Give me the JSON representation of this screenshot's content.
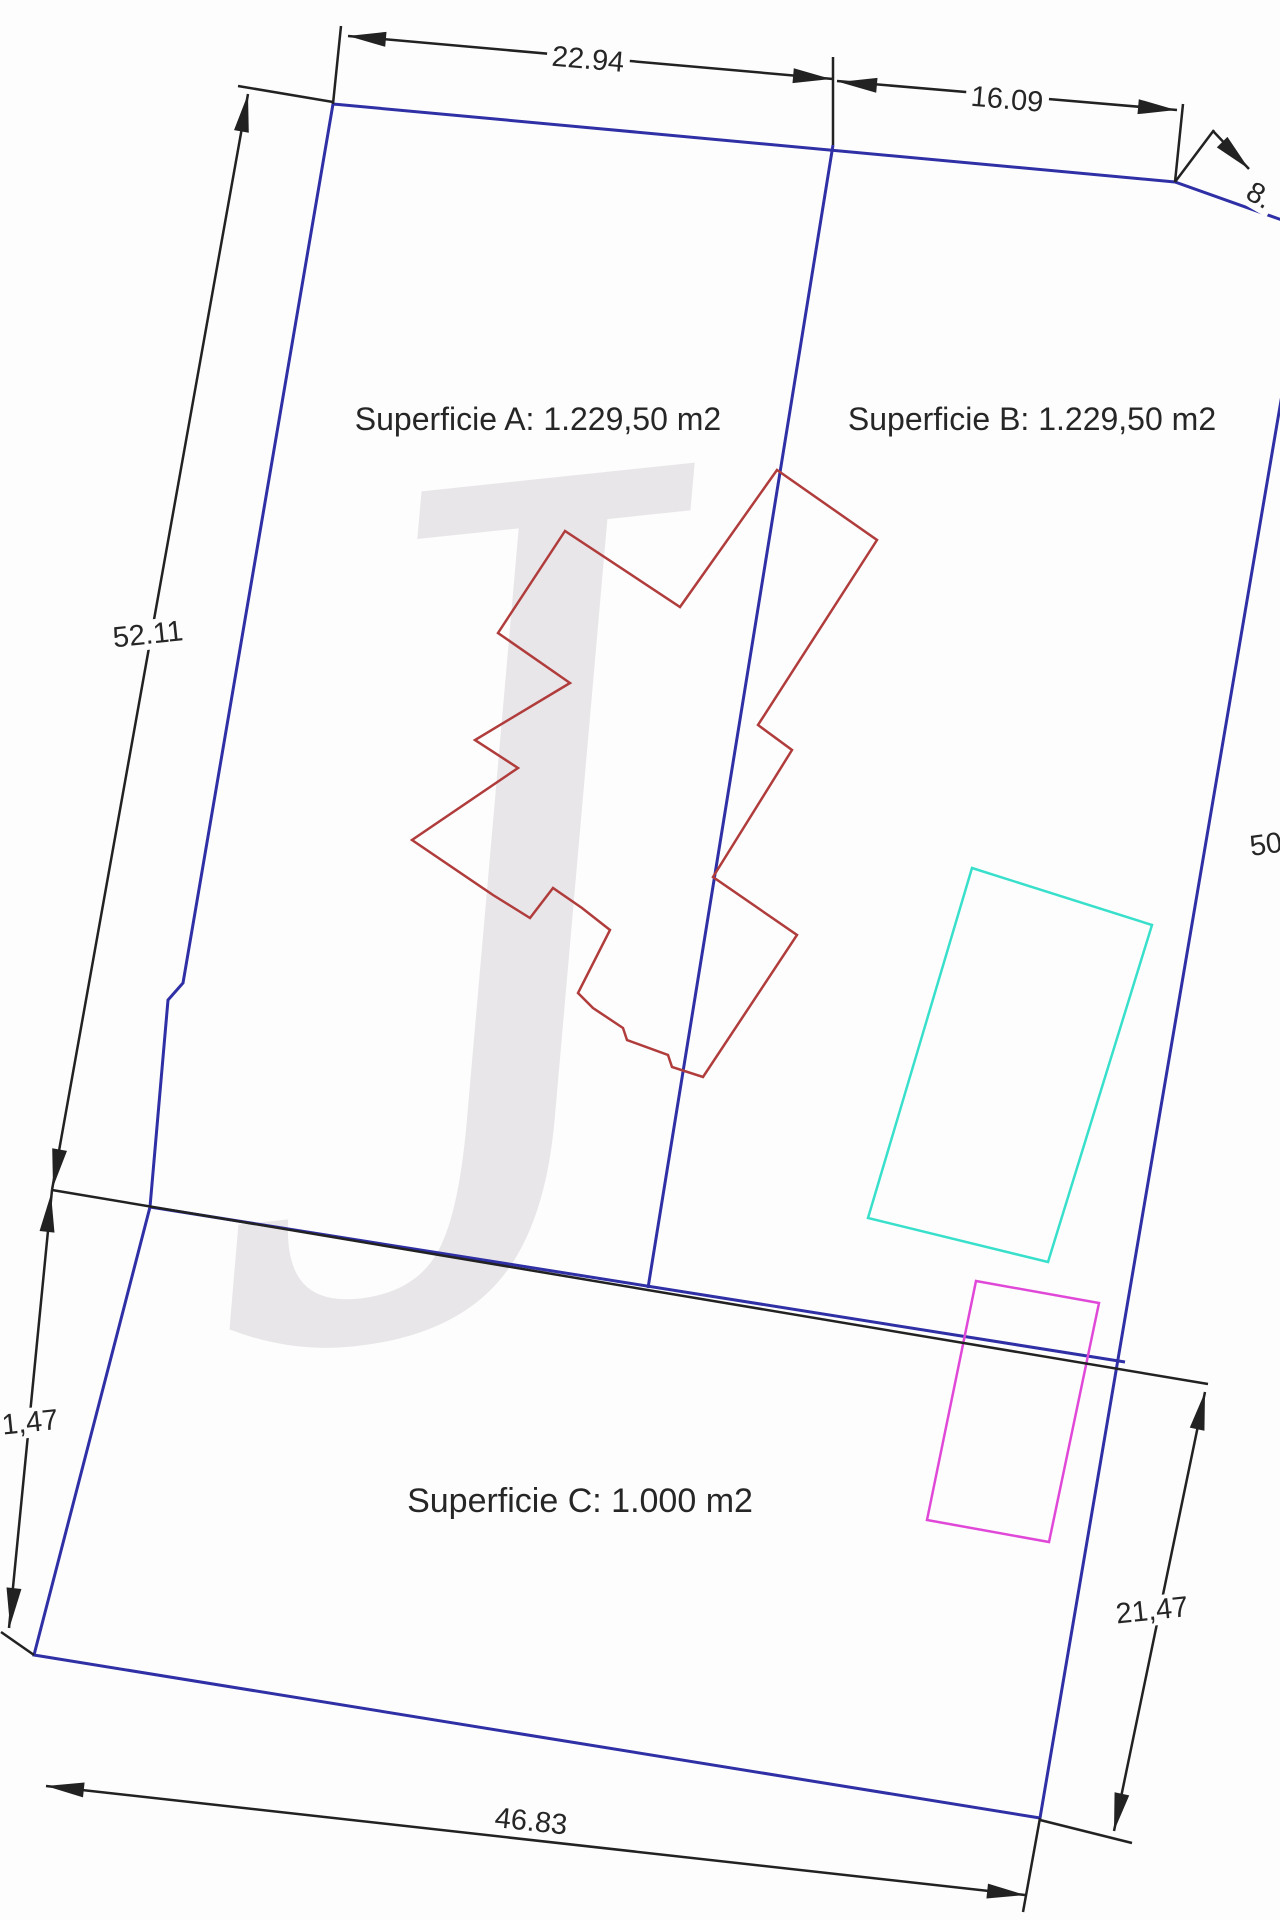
{
  "colors": {
    "blue": "#2f2fa6",
    "red": "#b03c3c",
    "cyan": "#38e0cb",
    "magenta": "#e048d8",
    "black": "#222222",
    "text": "#262626",
    "watermark": "#c9c2c9"
  },
  "areas": {
    "a": {
      "label": "Superficie A: 1.229,50 m2"
    },
    "b": {
      "label": "Superficie B: 1.229,50 m2"
    },
    "c": {
      "label": "Superficie C: 1.000 m2"
    }
  },
  "watermark": {
    "glyph": "J"
  },
  "labels": {
    "area-a": {
      "text": "Superficie A: 1.229,50 m2",
      "x": 538,
      "y": 420,
      "rot": 0,
      "size": 32,
      "dim": false
    },
    "area-b": {
      "text": "Superficie B: 1.229,50 m2",
      "x": 1032,
      "y": 420,
      "rot": 0,
      "size": 32,
      "dim": false
    },
    "area-c": {
      "text": "Superficie C: 1.000 m2",
      "x": 580,
      "y": 1502,
      "rot": 0,
      "size": 34,
      "dim": false
    },
    "dim-top-left": {
      "text": "22.94",
      "x": 588,
      "y": 60,
      "rot": 5,
      "size": 29,
      "dim": true
    },
    "dim-top-right": {
      "text": "16.09",
      "x": 1007,
      "y": 100,
      "rot": 5,
      "size": 29,
      "dim": true
    },
    "dim-diagonal": {
      "text": "8.",
      "x": 1259,
      "y": 196,
      "rot": 30,
      "size": 29,
      "dim": true
    },
    "dim-left": {
      "text": "52.11",
      "x": 148,
      "y": 635,
      "rot": -6,
      "size": 29,
      "dim": true
    },
    "dim-right": {
      "text": "50",
      "x": 1266,
      "y": 845,
      "rot": -8,
      "size": 29,
      "dim": true
    },
    "dim-bottom-left": {
      "text": "1,47",
      "x": 30,
      "y": 1423,
      "rot": -6,
      "size": 29,
      "dim": true
    },
    "dim-bottom-right": {
      "text": "21,47",
      "x": 1152,
      "y": 1611,
      "rot": -6,
      "size": 29,
      "dim": true
    },
    "dim-bottom": {
      "text": "46.83",
      "x": 531,
      "y": 1822,
      "rot": 6,
      "size": 29,
      "dim": true
    }
  },
  "geometry": {
    "shapes": [
      {
        "name": "parcel-boundary",
        "type": "polygon",
        "color": "blue",
        "width": 3,
        "points": [
          [
            333,
            104
          ],
          [
            1175,
            182
          ],
          [
            1310,
            230
          ],
          [
            1040,
            1818
          ],
          [
            34,
            1655
          ],
          [
            150,
            1207
          ],
          [
            168,
            1000
          ],
          [
            183,
            983
          ]
        ]
      },
      {
        "name": "divider-a-b",
        "type": "polyline",
        "color": "blue",
        "width": 3,
        "points": [
          [
            833,
            145
          ],
          [
            648,
            1288
          ]
        ]
      },
      {
        "name": "divider-c",
        "type": "polyline",
        "color": "blue",
        "width": 3,
        "points": [
          [
            150,
            1207
          ],
          [
            1125,
            1362
          ]
        ]
      },
      {
        "name": "building-outline",
        "type": "polygon",
        "color": "red",
        "width": 2.5,
        "points": [
          [
            565,
            531
          ],
          [
            498,
            633
          ],
          [
            570,
            683
          ],
          [
            475,
            740
          ],
          [
            518,
            768
          ],
          [
            412,
            840
          ],
          [
            493,
            895
          ],
          [
            530,
            918
          ],
          [
            553,
            888
          ],
          [
            582,
            908
          ],
          [
            610,
            930
          ],
          [
            578,
            993
          ],
          [
            593,
            1008
          ],
          [
            623,
            1028
          ],
          [
            627,
            1040
          ],
          [
            668,
            1055
          ],
          [
            672,
            1067
          ],
          [
            703,
            1077
          ],
          [
            797,
            935
          ],
          [
            713,
            877
          ],
          [
            792,
            750
          ],
          [
            758,
            725
          ],
          [
            877,
            540
          ],
          [
            777,
            470
          ],
          [
            680,
            607
          ]
        ]
      },
      {
        "name": "cyan-structure",
        "type": "polygon",
        "color": "cyan",
        "width": 2.5,
        "points": [
          [
            972,
            868
          ],
          [
            1152,
            925
          ],
          [
            1048,
            1262
          ],
          [
            868,
            1218
          ]
        ]
      },
      {
        "name": "magenta-structure",
        "type": "polygon",
        "color": "magenta",
        "width": 2.5,
        "points": [
          [
            976,
            1281
          ],
          [
            1099,
            1303
          ],
          [
            1049,
            1542
          ],
          [
            927,
            1520
          ]
        ]
      },
      {
        "name": "dim-line-22-94",
        "type": "polyline",
        "color": "black",
        "width": 2.5,
        "points": [
          [
            348,
            36
          ],
          [
            833,
            79
          ]
        ]
      },
      {
        "name": "dim-line-16-09",
        "type": "polyline",
        "color": "black",
        "width": 2.5,
        "points": [
          [
            837,
            81
          ],
          [
            1177,
            110
          ]
        ]
      },
      {
        "name": "dim-line-8",
        "type": "polyline",
        "color": "black",
        "width": 2.5,
        "points": [
          [
            1213,
            131
          ],
          [
            1249,
            169
          ]
        ]
      },
      {
        "name": "ext-line-top-left-v",
        "type": "polyline",
        "color": "black",
        "width": 2.5,
        "points": [
          [
            341,
            26
          ],
          [
            333,
            104
          ]
        ]
      },
      {
        "name": "ext-line-top-mid",
        "type": "polyline",
        "color": "black",
        "width": 2.5,
        "points": [
          [
            833,
            57
          ],
          [
            833,
            145
          ]
        ]
      },
      {
        "name": "ext-line-top-right",
        "type": "polyline",
        "color": "black",
        "width": 2.5,
        "points": [
          [
            1183,
            104
          ],
          [
            1175,
            182
          ]
        ]
      },
      {
        "name": "ext-line-top-left-h",
        "type": "polyline",
        "color": "black",
        "width": 2.5,
        "points": [
          [
            238,
            86
          ],
          [
            333,
            102
          ]
        ]
      },
      {
        "name": "dim-line-52-11",
        "type": "polyline",
        "color": "black",
        "width": 2.5,
        "points": [
          [
            248,
            94
          ],
          [
            52,
            1190
          ]
        ]
      },
      {
        "name": "dim-line-21-47-left",
        "type": "polyline",
        "color": "black",
        "width": 2.5,
        "points": [
          [
            52,
            1190
          ],
          [
            9,
            1628
          ]
        ]
      },
      {
        "name": "ext-line-bottom-left",
        "type": "polyline",
        "color": "black",
        "width": 2.5,
        "points": [
          [
            34,
            1655
          ],
          [
            1,
            1632
          ]
        ]
      },
      {
        "name": "ext-line-middle-long",
        "type": "polyline",
        "color": "black",
        "width": 2.5,
        "points": [
          [
            52,
            1190
          ],
          [
            1208,
            1384
          ]
        ]
      },
      {
        "name": "dim-line-21-47-right",
        "type": "polyline",
        "color": "black",
        "width": 2.5,
        "points": [
          [
            1205,
            1392
          ],
          [
            1114,
            1831
          ]
        ]
      },
      {
        "name": "ext-line-bottom-right-h",
        "type": "polyline",
        "color": "black",
        "width": 2.5,
        "points": [
          [
            1040,
            1820
          ],
          [
            1132,
            1843
          ]
        ]
      },
      {
        "name": "ext-line-bottom-right-v",
        "type": "polyline",
        "color": "black",
        "width": 2.5,
        "points": [
          [
            1040,
            1818
          ],
          [
            1023,
            1912
          ]
        ]
      },
      {
        "name": "dim-line-46-83",
        "type": "polyline",
        "color": "black",
        "width": 2.5,
        "points": [
          [
            46,
            1786
          ],
          [
            1025,
            1895
          ]
        ]
      },
      {
        "name": "ext-line-peak-8",
        "type": "polyline",
        "color": "black",
        "width": 2.5,
        "points": [
          [
            1175,
            182
          ],
          [
            1214,
            130
          ]
        ]
      }
    ],
    "arrows": [
      {
        "name": "arrowhead",
        "x": 348,
        "y": 36,
        "angle": 185
      },
      {
        "name": "arrowhead",
        "x": 831,
        "y": 79,
        "angle": 5
      },
      {
        "name": "arrowhead",
        "x": 839,
        "y": 82,
        "angle": 185
      },
      {
        "name": "arrowhead",
        "x": 1176,
        "y": 110,
        "angle": 5
      },
      {
        "name": "arrowhead",
        "x": 1249,
        "y": 169,
        "angle": 45
      },
      {
        "name": "arrowhead",
        "x": 248,
        "y": 94,
        "angle": -80
      },
      {
        "name": "arrowhead",
        "x": 53,
        "y": 1187,
        "angle": 100
      },
      {
        "name": "arrowhead",
        "x": 51,
        "y": 1194,
        "angle": -84
      },
      {
        "name": "arrowhead",
        "x": 10,
        "y": 1626,
        "angle": 96
      },
      {
        "name": "arrowhead",
        "x": 1205,
        "y": 1392,
        "angle": -78
      },
      {
        "name": "arrowhead",
        "x": 1114,
        "y": 1831,
        "angle": 102
      },
      {
        "name": "arrowhead",
        "x": 46,
        "y": 1786,
        "angle": 186
      },
      {
        "name": "arrowhead",
        "x": 1025,
        "y": 1895,
        "angle": 6
      }
    ]
  }
}
